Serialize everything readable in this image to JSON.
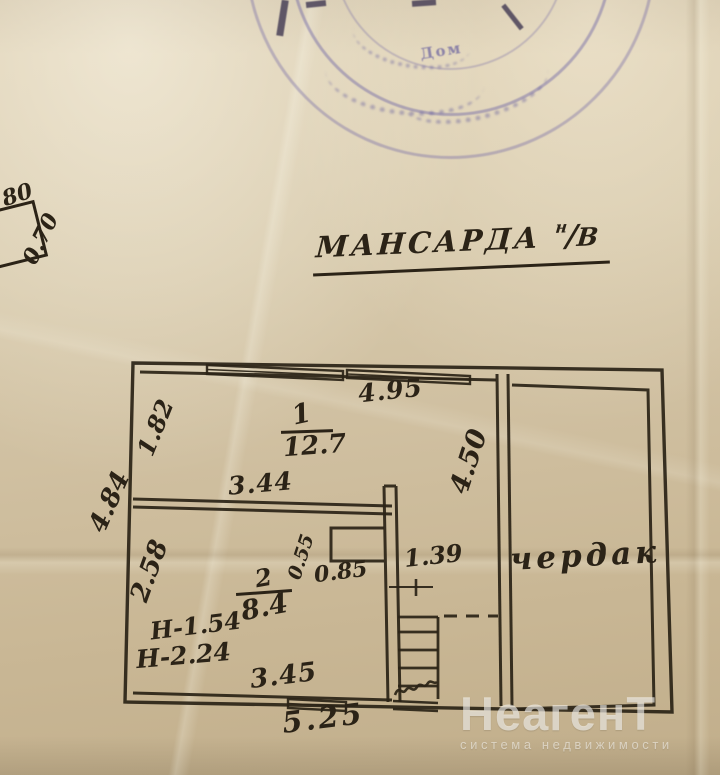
{
  "stamp": {
    "text_fragment": "Дом"
  },
  "margin_notes": {
    "top_number": "80",
    "side_number": "0.70"
  },
  "title": {
    "main": "МАНСАРДА",
    "suffix_numerator": "н",
    "suffix_slash": "/",
    "suffix_denominator": "В"
  },
  "plan": {
    "room1": {
      "number": "1",
      "area": "12.7"
    },
    "room2": {
      "number": "2",
      "area": "8.4"
    },
    "attic_label": "чердак",
    "dims": {
      "top_width": "4.95",
      "room1_inner_width": "3.44",
      "room1_left_height": "1.82",
      "left_outer_height": "4.84",
      "room2_left_height": "2.58",
      "attic_inner_height": "4.50",
      "niche_depth": "0.55",
      "niche_width": "0.85",
      "hall_width": "1.39",
      "room2_inner_width": "3.45",
      "bottom_width": "5.25"
    },
    "heights": {
      "h1": "Н-1.54",
      "h2": "Н-2.24"
    }
  },
  "watermark": {
    "brand": "НеагенТ",
    "tagline": "система недвижимости"
  },
  "colors": {
    "ink": "#2b2317",
    "stamp": "#7066a6",
    "paper": "#d4c5a6"
  }
}
